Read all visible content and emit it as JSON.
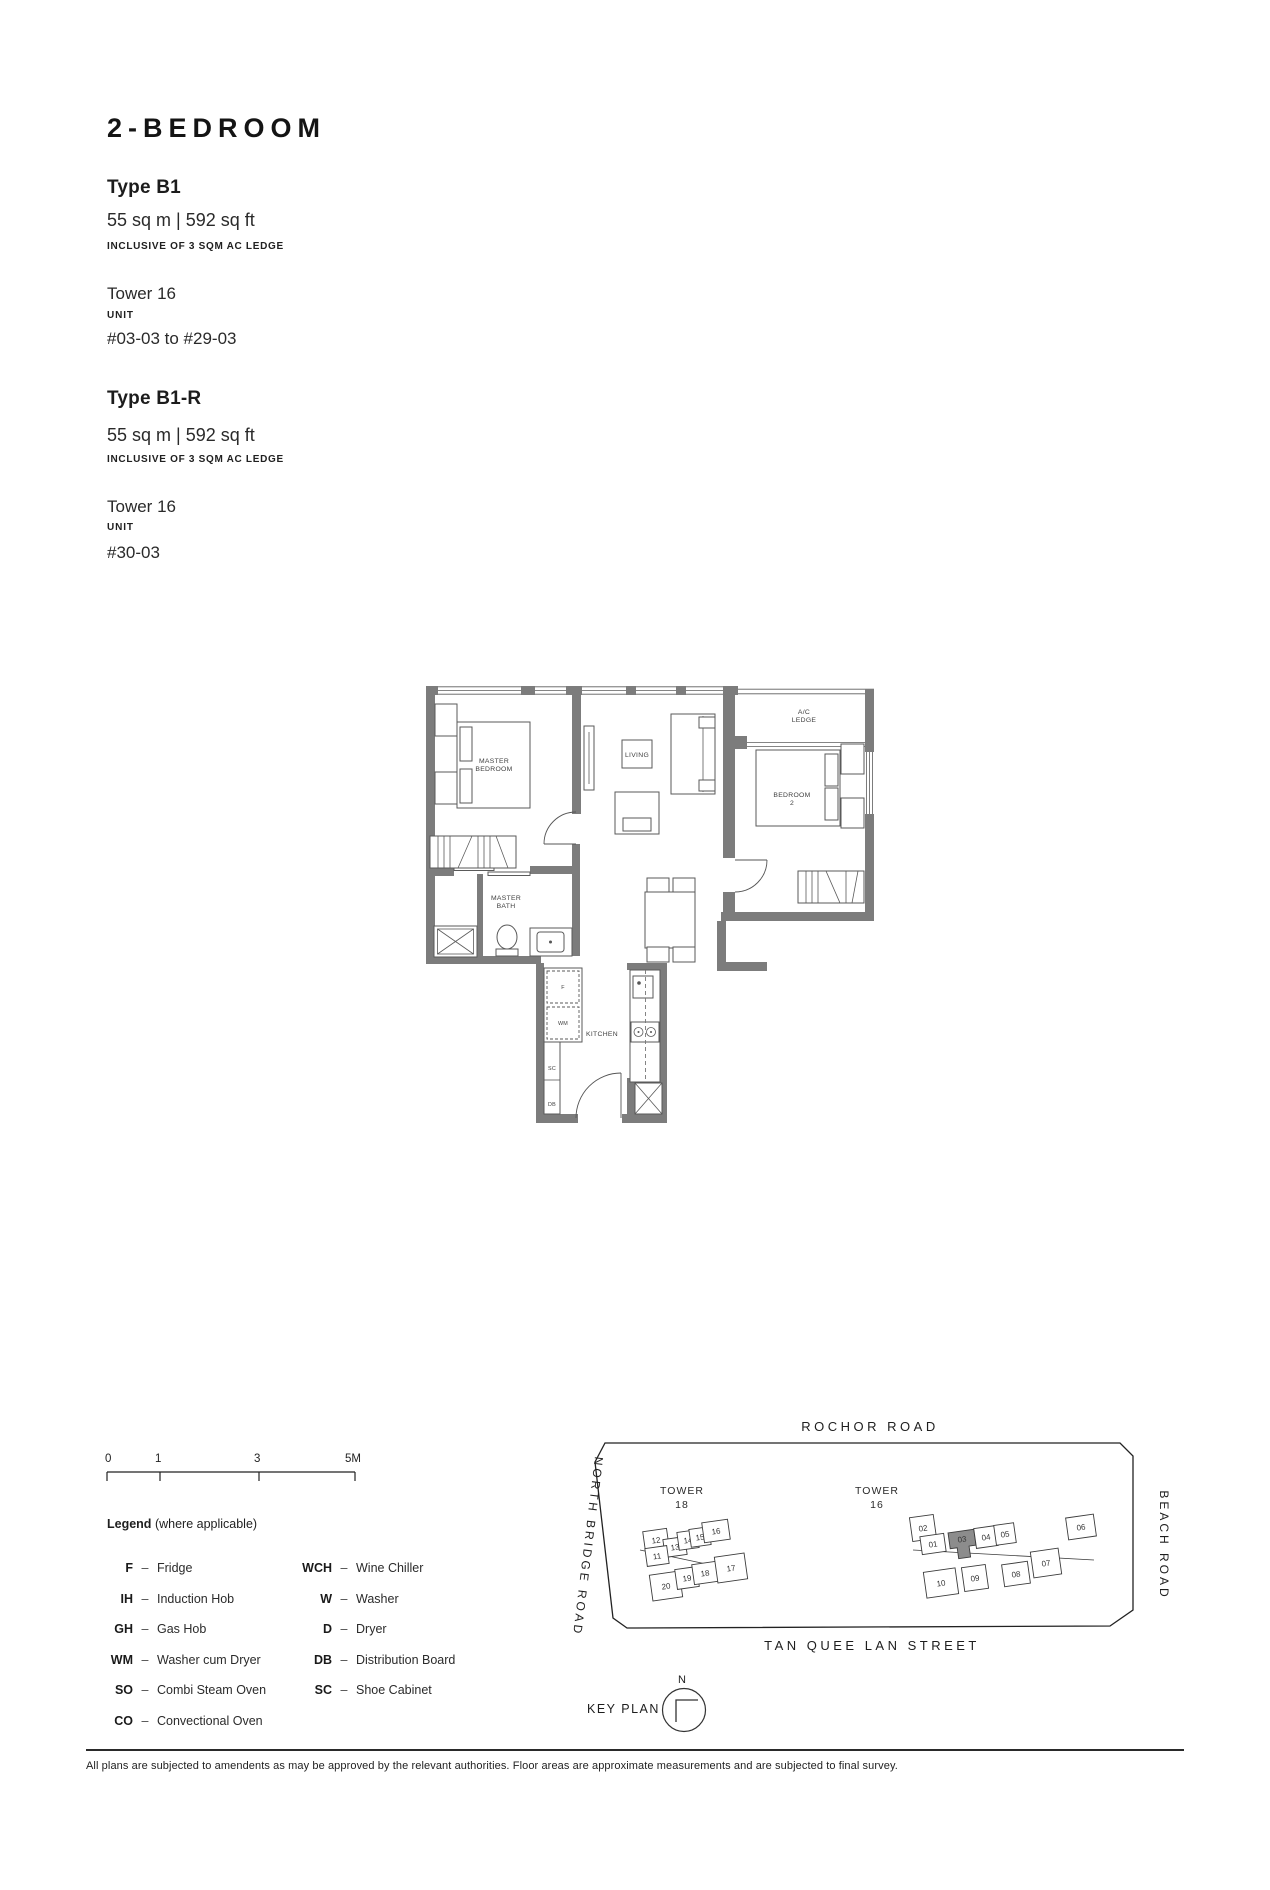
{
  "header": {
    "title": "2-BEDROOM",
    "types": [
      {
        "name": "Type B1",
        "area": "55 sq m | 592 sq ft",
        "area_note": "INCLUSIVE OF 3 SQM AC LEDGE",
        "tower": "Tower 16",
        "unit_label": "UNIT",
        "unit_range": "#03-03 to #29-03"
      },
      {
        "name": "Type B1-R",
        "area": "55 sq m | 592 sq ft",
        "area_note": "INCLUSIVE OF 3 SQM AC LEDGE",
        "tower": "Tower 16",
        "unit_label": "UNIT",
        "unit_range": "#30-03"
      }
    ]
  },
  "floor_plan": {
    "wall_color": "#7c7c7c",
    "rooms": {
      "master_bedroom_1": "MASTER",
      "master_bedroom_2": "BEDROOM",
      "living": "LIVING",
      "ac_ledge_1": "A/C",
      "ac_ledge_2": "LEDGE",
      "bedroom2_1": "BEDROOM",
      "bedroom2_2": "2",
      "master_bath_1": "MASTER",
      "master_bath_2": "BATH",
      "dining": "DINING",
      "kitchen": "KITCHEN"
    },
    "appliances": {
      "fridge": "F",
      "washer_cum_dryer": "WM",
      "shoe_cabinet": "SC",
      "distribution_board": "DB"
    }
  },
  "scale_bar": {
    "ticks": [
      "0",
      "1",
      "3",
      "5M"
    ]
  },
  "legend": {
    "title": "Legend",
    "note": "(where applicable)",
    "dash": "–",
    "left": [
      {
        "abbr": "F",
        "desc": "Fridge"
      },
      {
        "abbr": "IH",
        "desc": "Induction Hob"
      },
      {
        "abbr": "GH",
        "desc": "Gas Hob"
      },
      {
        "abbr": "WM",
        "desc": "Washer cum Dryer"
      },
      {
        "abbr": "SO",
        "desc": "Combi Steam Oven"
      },
      {
        "abbr": "CO",
        "desc": "Convectional Oven"
      }
    ],
    "right": [
      {
        "abbr": "WCH",
        "desc": "Wine Chiller"
      },
      {
        "abbr": "W",
        "desc": "Washer"
      },
      {
        "abbr": "D",
        "desc": "Dryer"
      },
      {
        "abbr": "DB",
        "desc": "Distribution Board"
      },
      {
        "abbr": "SC",
        "desc": "Shoe Cabinet"
      }
    ]
  },
  "key_plan": {
    "label": "KEY PLAN",
    "north": "N",
    "highlight_color": "#8c8c8c",
    "roads": {
      "top": "ROCHOR ROAD",
      "left": "NORTH BRIDGE ROAD",
      "right": "BEACH ROAD",
      "bottom": "TAN QUEE LAN STREET"
    },
    "towers": [
      {
        "name_1": "TOWER",
        "name_2": "18",
        "units": [
          "12",
          "13",
          "14",
          "15",
          "16",
          "11",
          "20",
          "19",
          "18",
          "17"
        ]
      },
      {
        "name_1": "TOWER",
        "name_2": "16",
        "highlighted": "03",
        "units": [
          "02",
          "01",
          "03",
          "04",
          "05",
          "06",
          "10",
          "09",
          "08",
          "07"
        ]
      }
    ]
  },
  "footer": {
    "disclaimer": "All plans are subjected to amendents as may be approved by the relevant authorities. Floor areas are approximate measurements and are subjected to final survey."
  }
}
